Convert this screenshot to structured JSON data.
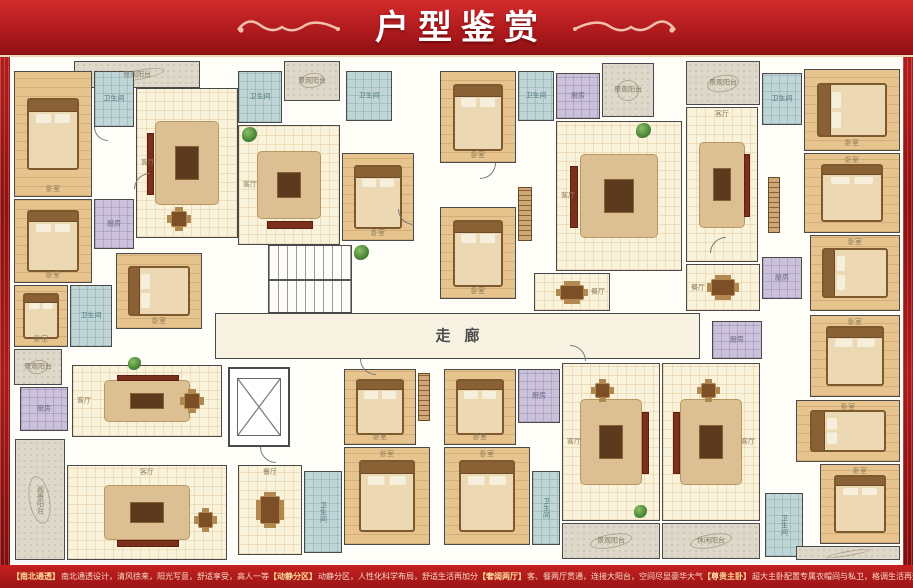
{
  "header": {
    "title": "户型鉴赏"
  },
  "footer": {
    "items": [
      {
        "tag": "【南北通透】",
        "text": "南北通透设计，清风徐来，阳光写意，舒适享受，高人一等"
      },
      {
        "tag": "【动静分区】",
        "text": "动静分区，人性化科学布局，舒适生活再加分"
      },
      {
        "tag": "【奢阔两厅】",
        "text": "客、餐两厅贯通，连接大阳台，空间尽显豪华大气"
      },
      {
        "tag": "【尊贵主卧】",
        "text": "超大主卧配置专属衣帽间与私卫，格调生活再升值"
      }
    ]
  },
  "colors": {
    "banner_red": "#b01b1e",
    "footer_red": "#b5191d",
    "accent_gold": "#ffdf9e",
    "wall": "#4a4a4a",
    "wood_floor": "#e7c48e",
    "tile_floor": "#faf3dc",
    "bath_blue": "#c0d5d6",
    "kitchen_purple": "#cbc1da",
    "balcony_gray": "#ded8ca"
  },
  "plan": {
    "rooms": [
      {
        "name": "balcony-top-left",
        "label": "景观阳台",
        "x": 64,
        "y": 4,
        "w": 126,
        "h": 27,
        "t": "balcony"
      },
      {
        "name": "bedroom-top-left-1",
        "label": "卧室",
        "x": 4,
        "y": 14,
        "w": 78,
        "h": 126,
        "t": "wood",
        "f": "bed",
        "lp": "b"
      },
      {
        "name": "bath-top-left",
        "label": "卫生间",
        "x": 84,
        "y": 14,
        "w": 40,
        "h": 56,
        "t": "bath"
      },
      {
        "name": "living-top-left",
        "label": "客厅",
        "x": 126,
        "y": 31,
        "w": 102,
        "h": 150,
        "t": "tile",
        "f": "sofa-l",
        "lp": "l"
      },
      {
        "name": "bedroom-top-left-2",
        "label": "卧室",
        "x": 4,
        "y": 142,
        "w": 78,
        "h": 84,
        "t": "wood",
        "f": "bed",
        "lp": "b"
      },
      {
        "name": "kitchen-top-left",
        "label": "厨房",
        "x": 84,
        "y": 142,
        "w": 40,
        "h": 50,
        "t": "kitchen"
      },
      {
        "name": "dining-zone-top-left",
        "label": "",
        "x": 146,
        "y": 142,
        "w": 46,
        "h": 40,
        "t": "zone",
        "f": "table"
      },
      {
        "name": "bedroom-left-small",
        "label": "卧室",
        "x": 4,
        "y": 228,
        "w": 54,
        "h": 62,
        "t": "wood",
        "f": "bed",
        "lp": "b"
      },
      {
        "name": "bath-left-mid",
        "label": "卫生间",
        "x": 60,
        "y": 228,
        "w": 42,
        "h": 62,
        "t": "bath"
      },
      {
        "name": "bedroom-left-mid",
        "label": "卧室",
        "x": 106,
        "y": 196,
        "w": 86,
        "h": 76,
        "t": "wood",
        "f": "bed-h",
        "lp": "b"
      },
      {
        "name": "bath-top-mid",
        "label": "卫生间",
        "x": 228,
        "y": 14,
        "w": 44,
        "h": 52,
        "t": "bath"
      },
      {
        "name": "balcony-top-mid",
        "label": "景观阳台",
        "x": 274,
        "y": 4,
        "w": 56,
        "h": 40,
        "t": "balcony"
      },
      {
        "name": "living-top-mid",
        "label": "客厅",
        "x": 228,
        "y": 68,
        "w": 102,
        "h": 120,
        "t": "tile",
        "f": "sofa-b",
        "lp": "l"
      },
      {
        "name": "bedroom-top-mid",
        "label": "卧室",
        "x": 332,
        "y": 96,
        "w": 72,
        "h": 88,
        "t": "wood",
        "f": "bed",
        "lp": "b"
      },
      {
        "name": "bath-top-center-small",
        "label": "卫生间",
        "x": 336,
        "y": 14,
        "w": 46,
        "h": 50,
        "t": "bath"
      },
      {
        "name": "stairwell",
        "label": "",
        "x": 258,
        "y": 188,
        "w": 84,
        "h": 68,
        "t": "stair"
      },
      {
        "name": "bedroom-top-center-1",
        "label": "卧室",
        "x": 430,
        "y": 14,
        "w": 76,
        "h": 92,
        "t": "wood",
        "f": "bed",
        "lp": "b"
      },
      {
        "name": "bath-top-center",
        "label": "卫生间",
        "x": 508,
        "y": 14,
        "w": 36,
        "h": 50,
        "t": "bath"
      },
      {
        "name": "kitchen-top-center",
        "label": "厨房",
        "x": 546,
        "y": 16,
        "w": 44,
        "h": 46,
        "t": "kitchen"
      },
      {
        "name": "balcony-top-center",
        "label": "景观阳台",
        "x": 592,
        "y": 6,
        "w": 52,
        "h": 54,
        "t": "balcony"
      },
      {
        "name": "wardrobe-top-center",
        "label": "",
        "x": 508,
        "y": 130,
        "w": 14,
        "h": 54,
        "t": "zone",
        "f": "wardrobe"
      },
      {
        "name": "bedroom-top-center-2",
        "label": "卧室",
        "x": 430,
        "y": 150,
        "w": 76,
        "h": 92,
        "t": "wood",
        "f": "bed",
        "lp": "b"
      },
      {
        "name": "living-top-center",
        "label": "客厅",
        "x": 546,
        "y": 64,
        "w": 126,
        "h": 150,
        "t": "tile",
        "f": "sofa-l",
        "lp": "l"
      },
      {
        "name": "dining-top-center",
        "label": "餐厅",
        "x": 524,
        "y": 216,
        "w": 76,
        "h": 38,
        "t": "tile",
        "f": "table",
        "lp": "r"
      },
      {
        "name": "balcony-top-right",
        "label": "景观阳台",
        "x": 676,
        "y": 4,
        "w": 74,
        "h": 44,
        "t": "balcony"
      },
      {
        "name": "bath-top-right",
        "label": "卫生间",
        "x": 752,
        "y": 16,
        "w": 40,
        "h": 52,
        "t": "bath"
      },
      {
        "name": "living-top-right",
        "label": "客厅",
        "x": 676,
        "y": 50,
        "w": 72,
        "h": 155,
        "t": "tile",
        "f": "sofa-r",
        "lp": "t"
      },
      {
        "name": "wardrobe-top-right",
        "label": "",
        "x": 758,
        "y": 120,
        "w": 12,
        "h": 56,
        "t": "zone",
        "f": "wardrobe"
      },
      {
        "name": "bedroom-top-right-1",
        "label": "卧室",
        "x": 794,
        "y": 12,
        "w": 96,
        "h": 82,
        "t": "wood",
        "f": "bed-h",
        "lp": "b"
      },
      {
        "name": "bedroom-top-right-2",
        "label": "卧室",
        "x": 794,
        "y": 96,
        "w": 96,
        "h": 80,
        "t": "wood",
        "f": "bed",
        "lp": "t"
      },
      {
        "name": "bedroom-top-right-3",
        "label": "卧室",
        "x": 800,
        "y": 178,
        "w": 90,
        "h": 76,
        "t": "wood",
        "f": "bed-h",
        "lp": "t"
      },
      {
        "name": "kitchen-top-right",
        "label": "厨房",
        "x": 752,
        "y": 200,
        "w": 40,
        "h": 42,
        "t": "kitchen"
      },
      {
        "name": "dining-top-right",
        "label": "餐厅",
        "x": 676,
        "y": 207,
        "w": 74,
        "h": 47,
        "t": "tile",
        "f": "table",
        "lp": "l"
      },
      {
        "name": "corridor",
        "label": "走廊",
        "x": 205,
        "y": 256,
        "w": 485,
        "h": 46,
        "t": "corr",
        "lp": "c"
      },
      {
        "name": "elevator",
        "label": "",
        "x": 218,
        "y": 310,
        "w": 62,
        "h": 80,
        "t": "elev"
      },
      {
        "name": "kitchen-mid-right",
        "label": "厨房",
        "x": 702,
        "y": 264,
        "w": 50,
        "h": 38,
        "t": "kitchen"
      },
      {
        "name": "bedroom-mid-right",
        "label": "卧室",
        "x": 800,
        "y": 258,
        "w": 90,
        "h": 82,
        "t": "wood",
        "f": "bed",
        "lp": "t"
      },
      {
        "name": "balcony-bottom-left-1",
        "label": "景观阳台",
        "x": 4,
        "y": 292,
        "w": 48,
        "h": 36,
        "t": "balcony"
      },
      {
        "name": "kitchen-bottom-left",
        "label": "厨房",
        "x": 10,
        "y": 330,
        "w": 48,
        "h": 44,
        "t": "kitchen"
      },
      {
        "name": "living-bottom-left-1",
        "label": "客厅",
        "x": 62,
        "y": 308,
        "w": 150,
        "h": 72,
        "t": "tile",
        "f": "sofa-t",
        "lp": "l"
      },
      {
        "name": "dining-zone-bottom-left-1",
        "label": "",
        "x": 160,
        "y": 322,
        "w": 44,
        "h": 44,
        "t": "zone",
        "f": "table"
      },
      {
        "name": "balcony-bottom-left-2",
        "label": "观景阳台",
        "x": 5,
        "y": 382,
        "w": 50,
        "h": 121,
        "t": "balcony",
        "v": true
      },
      {
        "name": "living-bottom-left-2",
        "label": "客厅",
        "x": 57,
        "y": 408,
        "w": 160,
        "h": 95,
        "t": "tile",
        "f": "sofa-b",
        "lp": "t"
      },
      {
        "name": "dining-zone-bottom-left-2",
        "label": "",
        "x": 175,
        "y": 442,
        "w": 40,
        "h": 42,
        "t": "zone",
        "f": "table"
      },
      {
        "name": "dining-bottom-center",
        "label": "餐厅",
        "x": 228,
        "y": 408,
        "w": 64,
        "h": 90,
        "t": "tile",
        "f": "table",
        "lp": "t"
      },
      {
        "name": "bath-bottom-center-left",
        "label": "卫生间",
        "x": 294,
        "y": 414,
        "w": 38,
        "h": 82,
        "t": "bath",
        "v": true
      },
      {
        "name": "bedroom-bottom-center-l1",
        "label": "卧室",
        "x": 334,
        "y": 312,
        "w": 72,
        "h": 76,
        "t": "wood",
        "f": "bed",
        "lp": "b"
      },
      {
        "name": "wardrobe-bottom-center",
        "label": "",
        "x": 408,
        "y": 316,
        "w": 12,
        "h": 48,
        "t": "zone",
        "f": "wardrobe"
      },
      {
        "name": "bedroom-bottom-center-l2",
        "label": "卧室",
        "x": 334,
        "y": 390,
        "w": 86,
        "h": 98,
        "t": "wood",
        "f": "bed",
        "lp": "t"
      },
      {
        "name": "bedroom-bottom-center-r1",
        "label": "卧室",
        "x": 434,
        "y": 312,
        "w": 72,
        "h": 76,
        "t": "wood",
        "f": "bed",
        "lp": "b"
      },
      {
        "name": "kitchen-bottom-center",
        "label": "厨房",
        "x": 508,
        "y": 312,
        "w": 42,
        "h": 54,
        "t": "kitchen"
      },
      {
        "name": "bedroom-bottom-center-r2",
        "label": "卧室",
        "x": 434,
        "y": 390,
        "w": 86,
        "h": 98,
        "t": "wood",
        "f": "bed",
        "lp": "t"
      },
      {
        "name": "bath-bottom-center-right",
        "label": "卫生间",
        "x": 522,
        "y": 414,
        "w": 28,
        "h": 74,
        "t": "bath",
        "v": true
      },
      {
        "name": "living-bottom-center-1",
        "label": "客厅",
        "x": 552,
        "y": 306,
        "w": 98,
        "h": 158,
        "t": "tile",
        "f": "sofa-r",
        "lp": "l"
      },
      {
        "name": "dining-zone-bottom-center-1",
        "label": "",
        "x": 572,
        "y": 314,
        "w": 40,
        "h": 38,
        "t": "zone",
        "f": "table"
      },
      {
        "name": "balcony-bottom-center-1",
        "label": "景观阳台",
        "x": 552,
        "y": 466,
        "w": 98,
        "h": 36,
        "t": "balcony"
      },
      {
        "name": "living-bottom-center-2",
        "label": "客厅",
        "x": 652,
        "y": 306,
        "w": 98,
        "h": 158,
        "t": "tile",
        "f": "sofa-l",
        "lp": "r"
      },
      {
        "name": "dining-zone-bottom-center-2",
        "label": "",
        "x": 678,
        "y": 314,
        "w": 40,
        "h": 38,
        "t": "zone",
        "f": "table"
      },
      {
        "name": "balcony-bottom-center-2",
        "label": "休闲阳台",
        "x": 652,
        "y": 466,
        "w": 98,
        "h": 36,
        "t": "balcony"
      },
      {
        "name": "bath-bottom-right",
        "label": "卫生间",
        "x": 755,
        "y": 436,
        "w": 38,
        "h": 64,
        "t": "bath",
        "v": true
      },
      {
        "name": "bedroom-bottom-right-1",
        "label": "卧室",
        "x": 786,
        "y": 343,
        "w": 104,
        "h": 62,
        "t": "wood",
        "f": "bed-h",
        "lp": "t"
      },
      {
        "name": "bedroom-bottom-right-2",
        "label": "卧室",
        "x": 810,
        "y": 407,
        "w": 80,
        "h": 80,
        "t": "wood",
        "f": "bed",
        "lp": "t"
      },
      {
        "name": "balcony-bottom-right",
        "label": "",
        "x": 786,
        "y": 489,
        "w": 104,
        "h": 14,
        "t": "balcony"
      },
      {
        "name": "plant-top-mid",
        "label": "",
        "x": 232,
        "y": 70,
        "w": 15,
        "h": 15,
        "t": "zone",
        "f": "plant"
      },
      {
        "name": "plant-center",
        "label": "",
        "x": 344,
        "y": 188,
        "w": 15,
        "h": 15,
        "t": "zone",
        "f": "plant"
      },
      {
        "name": "plant-top-right",
        "label": "",
        "x": 626,
        "y": 66,
        "w": 15,
        "h": 15,
        "t": "zone",
        "f": "plant"
      },
      {
        "name": "plant-bottom-center",
        "label": "",
        "x": 624,
        "y": 448,
        "w": 13,
        "h": 13,
        "t": "zone",
        "f": "plant"
      },
      {
        "name": "plant-bottom-left",
        "label": "",
        "x": 118,
        "y": 300,
        "w": 13,
        "h": 13,
        "t": "zone",
        "f": "plant"
      }
    ],
    "doors": [
      {
        "x": 84,
        "y": 70,
        "w": 14,
        "h": 14,
        "r": 0
      },
      {
        "x": 124,
        "y": 116,
        "w": 16,
        "h": 16,
        "r": 90
      },
      {
        "x": 388,
        "y": 152,
        "w": 16,
        "h": 16,
        "r": 0
      },
      {
        "x": 470,
        "y": 106,
        "w": 16,
        "h": 16,
        "r": 270
      },
      {
        "x": 350,
        "y": 302,
        "w": 16,
        "h": 16,
        "r": 0
      },
      {
        "x": 560,
        "y": 288,
        "w": 16,
        "h": 16,
        "r": 180
      },
      {
        "x": 700,
        "y": 180,
        "w": 16,
        "h": 16,
        "r": 90
      },
      {
        "x": 250,
        "y": 390,
        "w": 16,
        "h": 16,
        "r": 0
      }
    ]
  }
}
